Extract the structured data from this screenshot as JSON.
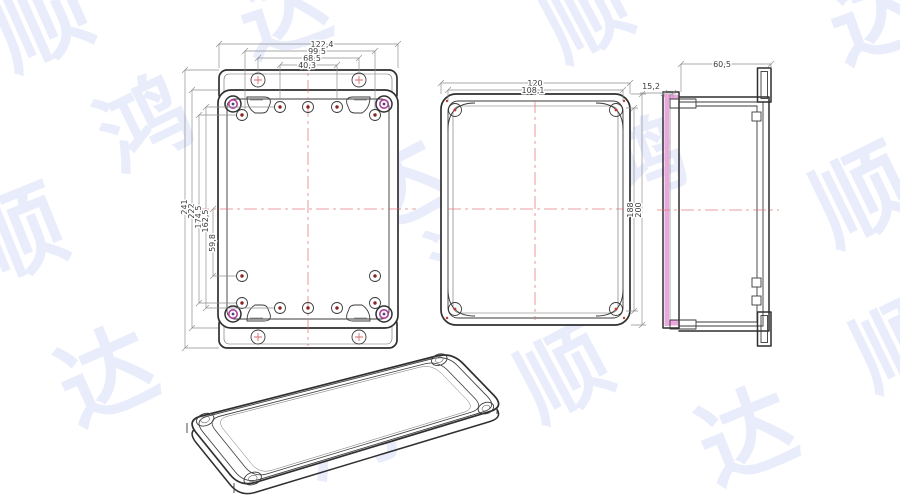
{
  "drawing_type": "enclosure technical drawing",
  "views": {
    "front": {
      "top_dims": [
        "122,4",
        "99,5",
        "68,5",
        "40,3"
      ],
      "left_dims": [
        "241",
        "222",
        "174,5",
        "162,5"
      ],
      "offset_dim": "59,8"
    },
    "lid": {
      "top_dims": [
        "120",
        "108,1"
      ],
      "right_dims": [
        "188",
        "200"
      ]
    },
    "section": {
      "top_dim": "60,5",
      "left_dim": "15,2"
    }
  },
  "colors": {
    "line": "#2f2f2f",
    "dimension": "#8f8f8f",
    "centerline": "#e06a6a",
    "gasket_pink": "#eba8de",
    "screw_fill": "#b4aadd",
    "screw_ring": "#b23f9f",
    "hole_dot": "#8b2222",
    "watermark": "#e9edfb"
  },
  "watermark": {
    "glyphs": [
      {
        "ch": "顺",
        "x": -5,
        "y": -25,
        "s": 95,
        "r": -24
      },
      {
        "ch": "达",
        "x": 240,
        "y": -30,
        "s": 90,
        "r": -18
      },
      {
        "ch": "顺",
        "x": 545,
        "y": -25,
        "s": 85,
        "r": -28
      },
      {
        "ch": "达",
        "x": 830,
        "y": -30,
        "s": 95,
        "r": -20
      },
      {
        "ch": "鸿",
        "x": 100,
        "y": 80,
        "s": 90,
        "r": -26
      },
      {
        "ch": "顺",
        "x": -30,
        "y": 190,
        "s": 95,
        "r": -22
      },
      {
        "ch": "达",
        "x": 350,
        "y": 140,
        "s": 95,
        "r": -28
      },
      {
        "ch": "鸿",
        "x": 600,
        "y": 120,
        "s": 85,
        "r": -20
      },
      {
        "ch": "顺",
        "x": 815,
        "y": 150,
        "s": 95,
        "r": -26
      },
      {
        "ch": "达",
        "x": 60,
        "y": 330,
        "s": 95,
        "r": -24
      },
      {
        "ch": "鸿",
        "x": 300,
        "y": 385,
        "s": 95,
        "r": -20
      },
      {
        "ch": "顺",
        "x": 520,
        "y": 330,
        "s": 90,
        "r": -28
      },
      {
        "ch": "达",
        "x": 700,
        "y": 390,
        "s": 95,
        "r": -22
      },
      {
        "ch": "顺",
        "x": 855,
        "y": 300,
        "s": 90,
        "r": -26
      },
      {
        "ch": "鸿",
        "x": 430,
        "y": 215,
        "s": 80,
        "r": -24
      }
    ]
  }
}
